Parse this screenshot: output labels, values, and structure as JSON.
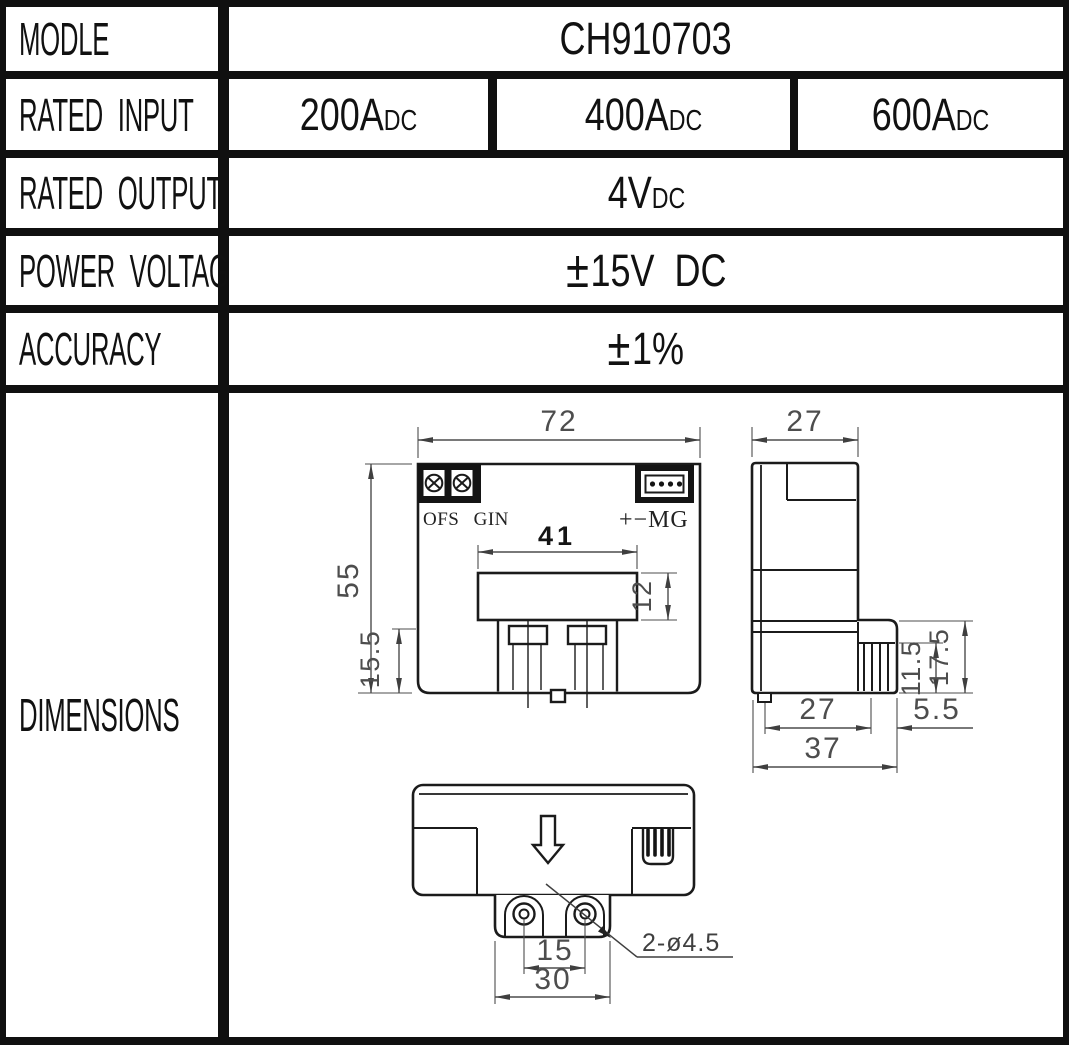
{
  "colors": {
    "table_border": "#101010",
    "drawing_outline": "#1b1b1b",
    "dimension_ink": "#4d4d4d"
  },
  "table": {
    "model": {
      "label": "MODLE",
      "value": "CH910703"
    },
    "rated_input": {
      "label": "RATED INPUT",
      "cells": [
        {
          "main": "200A",
          "sub": "DC"
        },
        {
          "main": "400A",
          "sub": "DC"
        },
        {
          "main": "600A",
          "sub": "DC"
        }
      ]
    },
    "rated_output": {
      "label": "RATED OUTPUT",
      "main": "4V",
      "sub": "DC"
    },
    "power_voltage": {
      "label": "POWER VOLTAGE",
      "pm": "±",
      "value": "15V  DC"
    },
    "accuracy": {
      "label": "ACCURACY",
      "pm": "±",
      "value": "1%"
    },
    "dimensions": {
      "label": "DIMENSIONS"
    }
  },
  "drawing": {
    "front": {
      "width": "72",
      "height": "55",
      "slot_width": "41",
      "slot_height": "12",
      "foot_height": "15.5",
      "trimmer_labels": "OFS GIN",
      "connector_label": "+−MG"
    },
    "side": {
      "width": "27",
      "conn_height": "11.5",
      "step_height": "17.5",
      "body_depth": "27",
      "conn_depth": "5.5",
      "total_depth": "37"
    },
    "bottom": {
      "hole_pitch": "15",
      "flange_width": "30",
      "hole_callout": "2-ø4.5"
    }
  }
}
